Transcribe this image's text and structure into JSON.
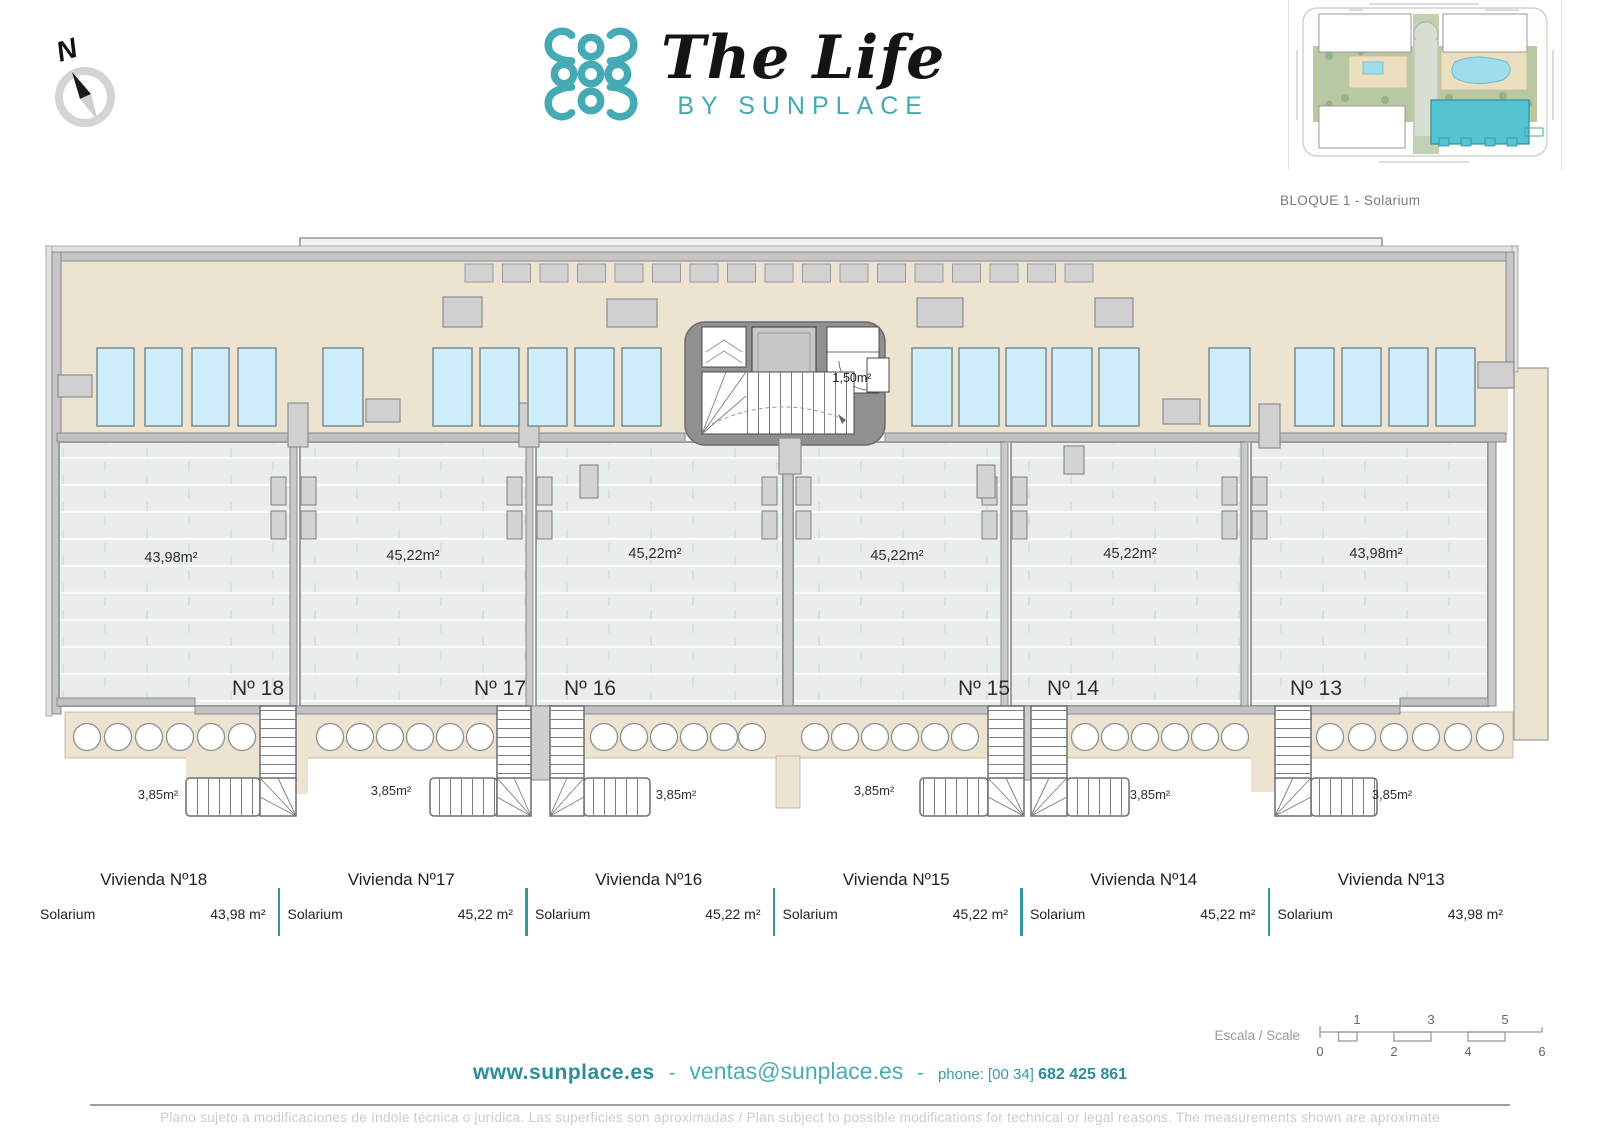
{
  "header": {
    "compass": "N",
    "brand_title": "The Life",
    "brand_subtitle": "BY SUNPLACE",
    "siteplan_caption": "BLOQUE 1 - Solarium"
  },
  "plan": {
    "stair_core_area": "1,50m²",
    "units": [
      {
        "number": "Nº 18",
        "solarium_area": "43,98m²",
        "stair_area": "3,85m²"
      },
      {
        "number": "Nº 17",
        "solarium_area": "45,22m²",
        "stair_area": "3,85m²"
      },
      {
        "number": "Nº 16",
        "solarium_area": "45,22m²",
        "stair_area": "3,85m²"
      },
      {
        "number": "Nº 15",
        "solarium_area": "45,22m²",
        "stair_area": "3,85m²"
      },
      {
        "number": "Nº 14",
        "solarium_area": "45,22m²",
        "stair_area": "3,85m²"
      },
      {
        "number": "Nº 13",
        "solarium_area": "43,98m²",
        "stair_area": "3,85m²"
      }
    ]
  },
  "summary_table": {
    "rows": [
      {
        "title": "Vivienda Nº18",
        "room": "Solarium",
        "area": "43,98 m²"
      },
      {
        "title": "Vivienda Nº17",
        "room": "Solarium",
        "area": "45,22 m²"
      },
      {
        "title": "Vivienda Nº16",
        "room": "Solarium",
        "area": "45,22 m²"
      },
      {
        "title": "Vivienda Nº15",
        "room": "Solarium",
        "area": "45,22 m²"
      },
      {
        "title": "Vivienda Nº14",
        "room": "Solarium",
        "area": "45,22 m²"
      },
      {
        "title": "Vivienda Nº13",
        "room": "Solarium",
        "area": "43,98 m²"
      }
    ]
  },
  "scale_bar": {
    "label": "Escala / Scale",
    "top_ticks": [
      "1",
      "3",
      "5"
    ],
    "bottom_ticks": [
      "0",
      "2",
      "4",
      "6"
    ]
  },
  "footer": {
    "website": "www.sunplace.es",
    "dash": "-",
    "email": "ventas@sunplace.es",
    "phone_prefix": "phone: [00 34]",
    "phone_number": "682 425 861",
    "disclaimer": "Plano sujeto a modificaciones de índole técnica o jurídica. Las superficies son aproximadas / Plan subject to possible modifications for technical or legal reasons. The measurements shown are aproximate"
  },
  "colors": {
    "teal": "#45aab4",
    "deck_beige": "#ece3d1",
    "sunbed_blue": "#cfeefb",
    "terrace_gray": "#e9edec",
    "wall_gray": "#c6c6c6"
  }
}
